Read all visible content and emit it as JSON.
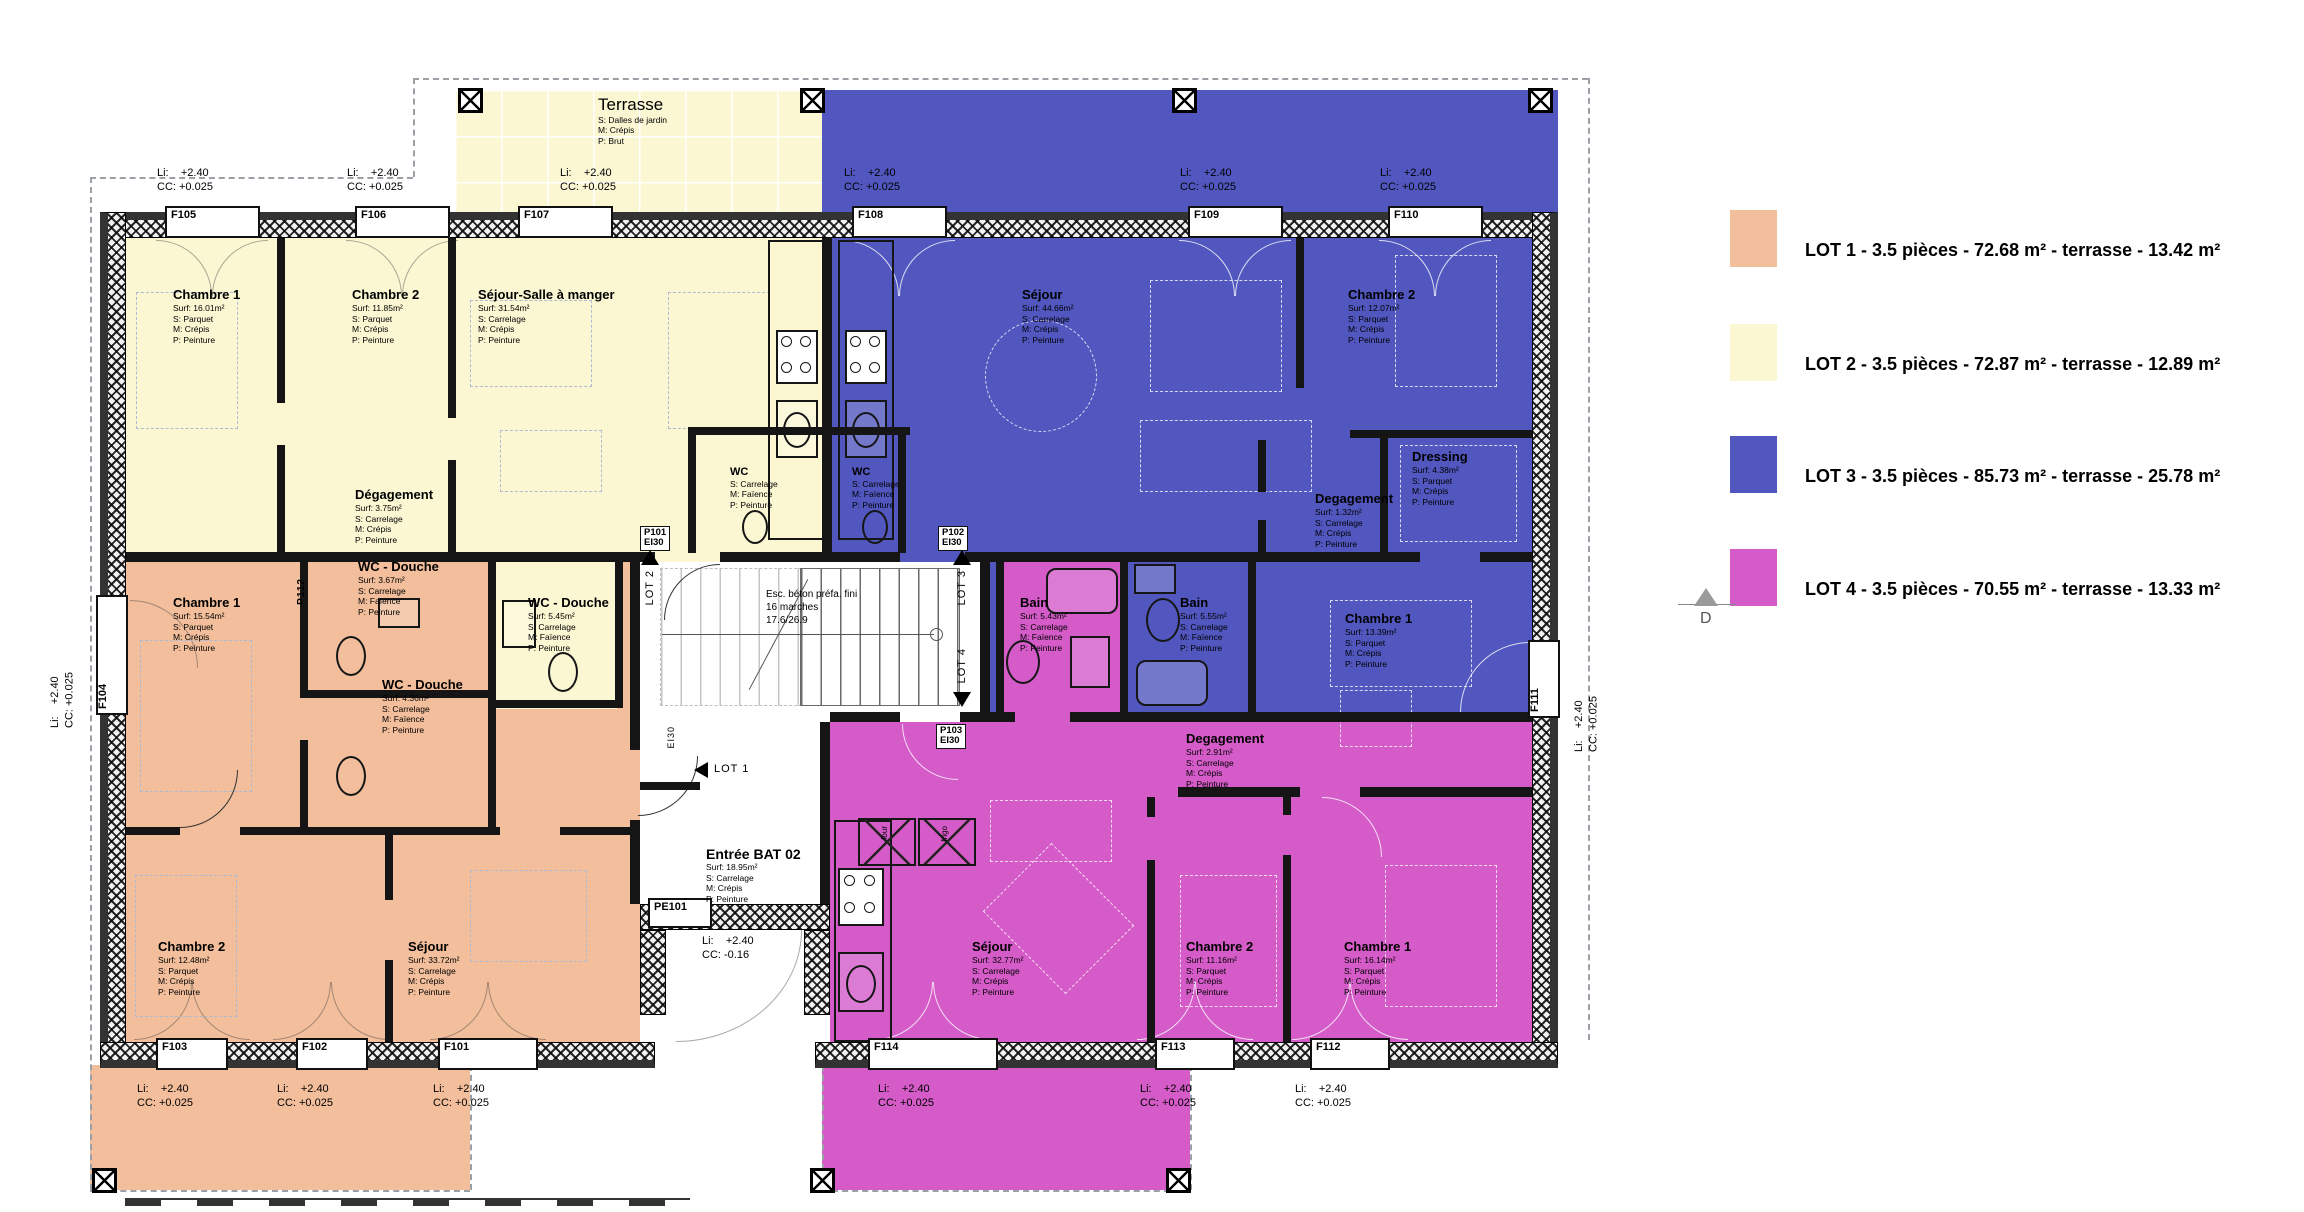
{
  "legend": {
    "items": [
      {
        "label": "LOT 1 -  3.5 pièces  - 72.68 m² - terrasse - 13.42 m²",
        "color": "#F2BE9B"
      },
      {
        "label": "LOT 2  -  3.5 pièces  - 72.87 m² - terrasse - 12.89 m²",
        "color": "#FBF7D3"
      },
      {
        "label": "LOT 3  -  3.5 pièces - 85.73 m² - terrasse - 25.78 m²",
        "color": "#5157BF"
      },
      {
        "label": "LOT 4  -  3.5 pièces  - 70.55 m² - terrasse - 13.33 m²",
        "color": "#D45BC8"
      }
    ],
    "section_marker": "D"
  },
  "colors": {
    "lot1": "#F2BE9B",
    "lot2": "#FBF7D3",
    "lot3": "#5157BF",
    "lot4": "#D45BC8",
    "wall": "#151515"
  },
  "terrasse": {
    "title": "Terrasse",
    "lines": [
      "S: Dalles de jardin",
      "M: Crépis",
      "P: Brut"
    ]
  },
  "rooms": {
    "y_ch1": {
      "title": "Chambre 1",
      "lines": [
        "Surf: 16.01m²",
        "S: Parquet",
        "M: Crépis",
        "P: Peinture"
      ]
    },
    "y_ch2": {
      "title": "Chambre 2",
      "lines": [
        "Surf: 11.85m²",
        "S: Parquet",
        "M: Crépis",
        "P: Peinture"
      ]
    },
    "y_sej": {
      "title": "Séjour-Salle à manger",
      "lines": [
        "Surf: 31.54m²",
        "S: Carrelage",
        "M: Crépis",
        "P: Peinture"
      ]
    },
    "y_deg": {
      "title": "Dégagement",
      "lines": [
        "Surf: 3.75m²",
        "S: Carrelage",
        "M: Crépis",
        "P: Peinture"
      ]
    },
    "y_wcd": {
      "title": "WC - Douche",
      "lines": [
        "Surf: 5.45m²",
        "S: Carrelage",
        "M: Faïence",
        "P: Peinture"
      ]
    },
    "y_wc": {
      "title": "WC",
      "lines": [
        "S: Carrelage",
        "M: Faïence",
        "P: Peinture"
      ]
    },
    "b_wc": {
      "title": "WC",
      "lines": [
        "S: Carrelage",
        "M: Faïence",
        "P: Peinture"
      ]
    },
    "b_sej": {
      "title": "Séjour",
      "lines": [
        "Surf: 44.66m²",
        "S: Carrelage",
        "M: Crépis",
        "P: Peinture"
      ]
    },
    "b_ch2": {
      "title": "Chambre 2",
      "lines": [
        "Surf: 12.07m²",
        "S: Parquet",
        "M: Crépis",
        "P: Peinture"
      ]
    },
    "b_dress": {
      "title": "Dressing",
      "lines": [
        "Surf: 4.38m²",
        "S: Parquet",
        "M: Crépis",
        "P: Peinture"
      ]
    },
    "b_deg": {
      "title": "Degagement",
      "lines": [
        "Surf: 1.32m²",
        "S: Carrelage",
        "M: Crépis",
        "P: Peinture"
      ]
    },
    "b_ch1": {
      "title": "Chambre 1",
      "lines": [
        "Surf: 13.39m²",
        "S: Parquet",
        "M: Crépis",
        "P: Peinture"
      ]
    },
    "b_bain": {
      "title": "Bain",
      "lines": [
        "Surf: 5.55m²",
        "S: Carrelage",
        "M: Faïence",
        "P: Peinture"
      ]
    },
    "o_ch1": {
      "title": "Chambre 1",
      "lines": [
        "Surf: 15.54m²",
        "S: Parquet",
        "M: Crépis",
        "P: Peinture"
      ]
    },
    "o_wcd1": {
      "title": "WC - Douche",
      "lines": [
        "Surf: 3.67m²",
        "S: Carrelage",
        "M: Faïence",
        "P: Peinture"
      ]
    },
    "o_wcd2": {
      "title": "WC - Douche",
      "lines": [
        "Surf: 4.36m²",
        "S: Carrelage",
        "M: Faïence",
        "P: Peinture"
      ]
    },
    "o_ch2": {
      "title": "Chambre 2",
      "lines": [
        "Surf: 12.48m²",
        "S: Parquet",
        "M: Crépis",
        "P: Peinture"
      ]
    },
    "o_sej": {
      "title": "Séjour",
      "lines": [
        "Surf: 33.72m²",
        "S: Carrelage",
        "M: Crépis",
        "P: Peinture"
      ]
    },
    "m_bain": {
      "title": "Bain",
      "lines": [
        "Surf: 5.43m²",
        "S: Carrelage",
        "M: Faïence",
        "P: Peinture"
      ]
    },
    "m_deg": {
      "title": "Degagement",
      "lines": [
        "Surf: 2.91m²",
        "S: Carrelage",
        "M: Crépis",
        "P: Peinture"
      ]
    },
    "m_sej": {
      "title": "Séjour",
      "lines": [
        "Surf: 32.77m²",
        "S: Carrelage",
        "M: Crépis",
        "P: Peinture"
      ]
    },
    "m_ch2": {
      "title": "Chambre 2",
      "lines": [
        "Surf: 11.16m²",
        "S: Parquet",
        "M: Crépis",
        "P: Peinture"
      ]
    },
    "m_ch1": {
      "title": "Chambre 1",
      "lines": [
        "Surf: 16.14m²",
        "S: Parquet",
        "M: Crépis",
        "P: Peinture"
      ]
    },
    "entree": {
      "title": "Entrée BAT 02",
      "lines": [
        "Surf: 18.95m²",
        "S: Carrelage",
        "M: Crépis",
        "P: Peinture"
      ]
    }
  },
  "stairs": {
    "lines": [
      "Esc. béton préfa. fini",
      "16 marches",
      "17.6/26.9"
    ]
  },
  "lots": {
    "lot1": "LOT 1",
    "lot2": "LOT 2",
    "lot3": "LOT 3",
    "lot4": "LOT 4"
  },
  "windows": {
    "f101": "F101",
    "f102": "F102",
    "f103": "F103",
    "f104": "F104",
    "f105": "F105",
    "f106": "F106",
    "f107": "F107",
    "f108": "F108",
    "f109": "F109",
    "f110": "F110",
    "f111": "F111",
    "f112": "F112",
    "f113": "F113",
    "f114": "F114",
    "p101": "P101",
    "p102": "P102",
    "p103": "P103",
    "p112": "P112",
    "pe101": "PE101",
    "ei30": "EI30"
  },
  "levels": {
    "li": "Li:    +2.40",
    "cc": "CC: +0.025",
    "cc_entry": "CC: -0.16"
  },
  "kitchen": {
    "four": "four",
    "frigo": "frigo"
  }
}
